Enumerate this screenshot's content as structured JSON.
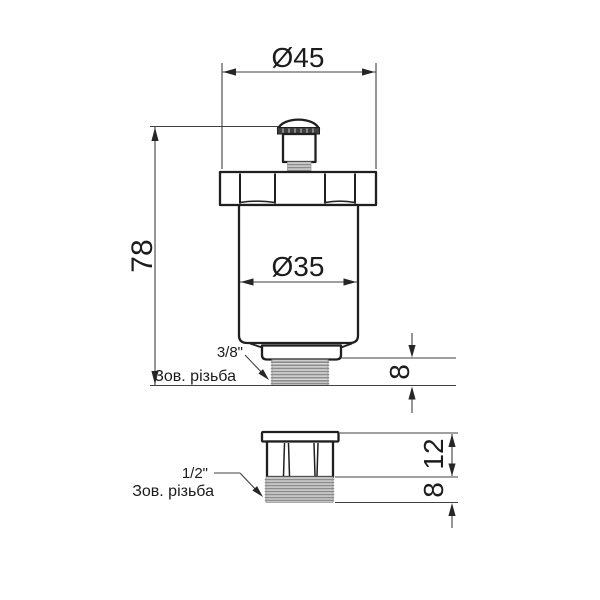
{
  "drawing": {
    "type": "technical-drawing",
    "subject": "automatic air vent valve with adapter",
    "language": "Ukrainian"
  },
  "main_view": {
    "top_diameter": "Ø45",
    "overall_height": "78",
    "body_diameter": "Ø35",
    "thread_length": "8",
    "thread_size": "3/8\"",
    "thread_note": "Зов. різьба"
  },
  "adapter_view": {
    "hex_height": "12",
    "thread_length": "8",
    "thread_size": "1/2\"",
    "thread_note": "Зов. різьба"
  },
  "colors": {
    "background": "#ffffff",
    "object_line": "#1f1f1f",
    "dimension_line": "#404040",
    "text": "#1c1c1c",
    "thread_fill": "#d9d9d9",
    "thread_line": "#8c8c8c",
    "knurl_band": "#3f3f3f"
  }
}
